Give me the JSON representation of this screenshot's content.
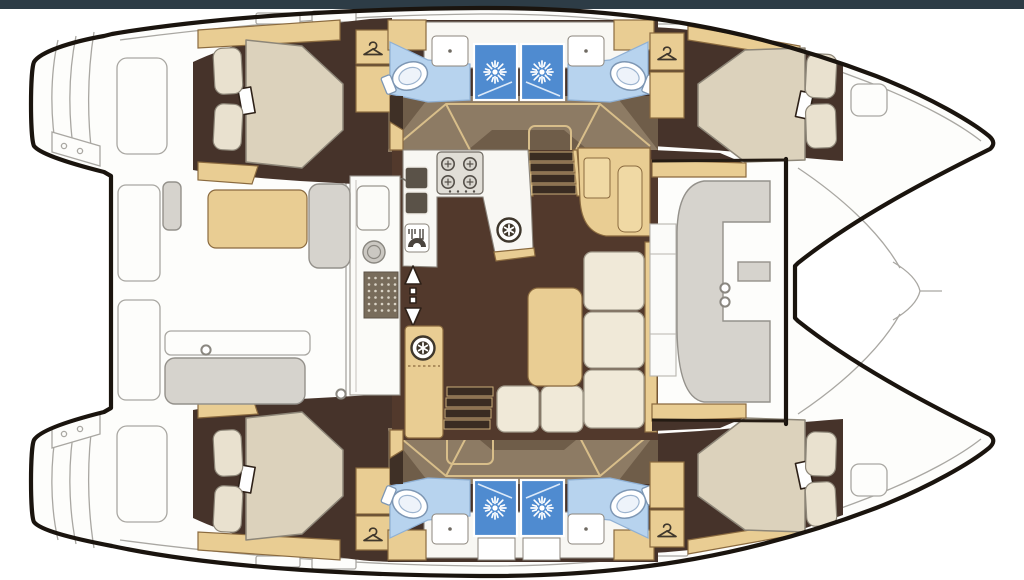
{
  "title": "Catamaran interior layout floor plan",
  "layout": {
    "type": "catamaran-floor-plan",
    "hulls": 2,
    "double_berth_cabins": 4,
    "bathrooms": 4,
    "shower_stalls": 4,
    "toilets": 4,
    "bathroom_sinks": 4,
    "wardrobes": 4,
    "stove_burners": 4,
    "galley_sinks": 2,
    "companionway_stairs": 2,
    "cockpits": 2
  },
  "colors": {
    "top_bar": "#2d3c46",
    "outline": "#1a140e",
    "thin_line": "#a9a7a2",
    "deck_white": "#fdfdfb",
    "floor_dark": "#46332a",
    "floor_salon": "#52392c",
    "corridor": "#8d7b64",
    "corridor_shadow": "#6f5d49",
    "wall_dark": "#3f3026",
    "wood": "#e9cd93",
    "wood_light": "#f0d9a4",
    "wood_stroke": "#8a6a3f",
    "wood_trim": "#d8be8a",
    "mattress": "#dcd2bc",
    "mattress_stroke": "#8d8678",
    "pillow": "#e9e1cf",
    "sofa": "#f0e9d8",
    "sofa_stroke": "#a49d8d",
    "bath_floor": "#b7d3ee",
    "bath_stroke": "#8fb0d4",
    "shower": "#4f8bd0",
    "shower_line": "#dce9f8",
    "counter": "#f8f7f3",
    "counter_stroke": "#8b857c",
    "bench": "#d6d3cd",
    "bench_stroke": "#94918b",
    "steel": "#e1ded7",
    "steel_stroke": "#6f6a62",
    "sink_dark": "#5a5248",
    "mat": "#786c5b",
    "mat_dot": "#d9d3c6",
    "icon_dark": "#3f372c"
  },
  "icons": {
    "shower": {
      "ref": "#ic-sun"
    },
    "wardrobe": {
      "ref": "#ic-hanger"
    },
    "vent": {
      "ref": "#ic-rosette"
    },
    "toilet": {
      "ref": "#ic-toilet"
    },
    "burner": {
      "ref": "#ic-burner"
    },
    "cleat": {
      "ref": "#ic-ring"
    }
  }
}
